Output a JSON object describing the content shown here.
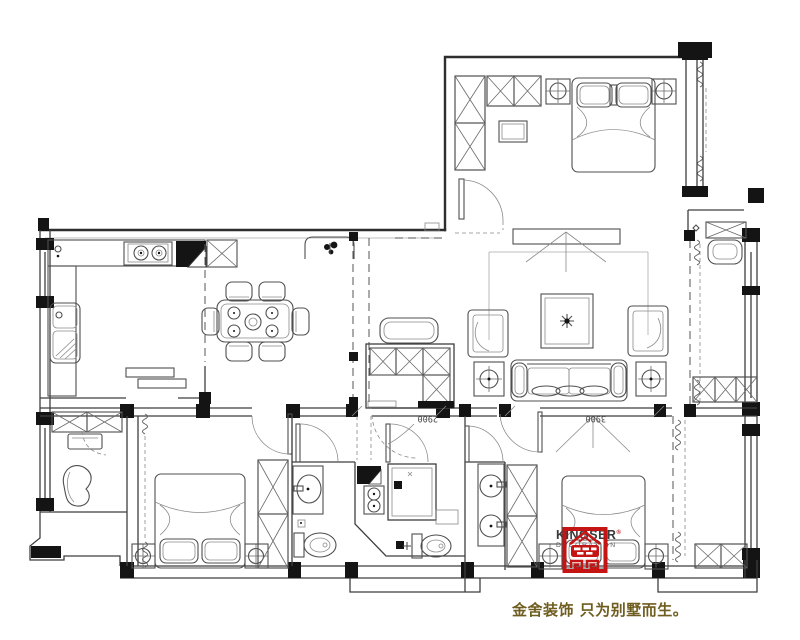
{
  "drawing": {
    "dimensions": [
      {
        "value": "2900"
      },
      {
        "value": "3900"
      }
    ]
  },
  "brand": {
    "name": "KINGSER",
    "registered": "®",
    "subtitle": "DECORATION",
    "slogan": "金舍装饰 只为别墅而生。"
  },
  "colors": {
    "logo_red": "#c41414",
    "slogan_gold": "#6f5c1f",
    "line": "#3d3d3d"
  }
}
